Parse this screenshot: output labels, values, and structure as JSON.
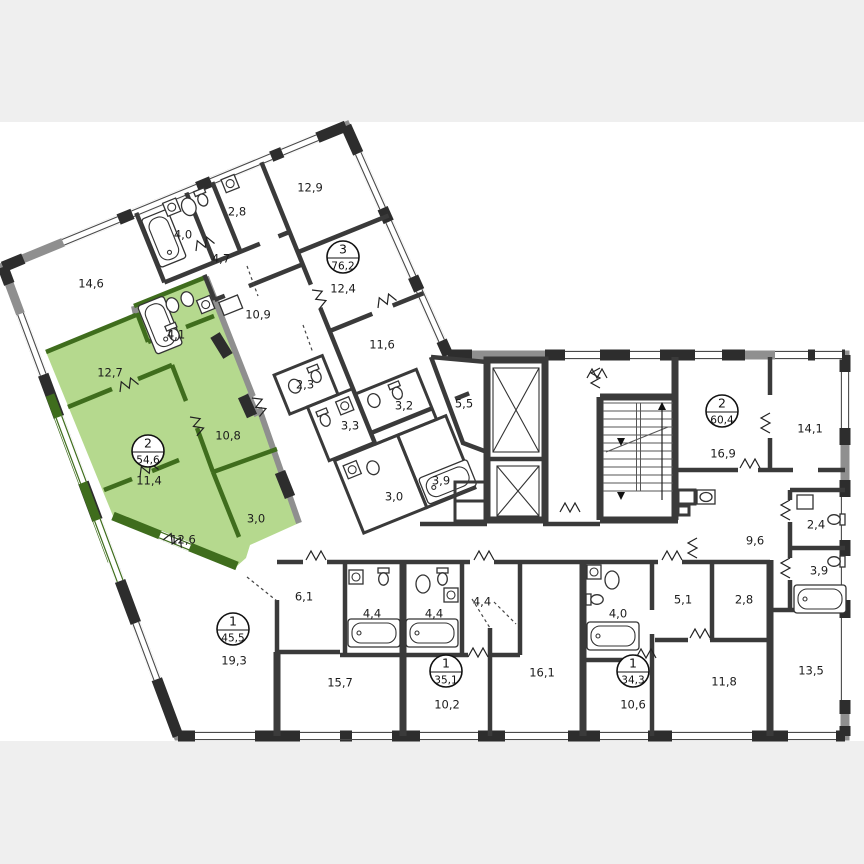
{
  "title": "Residential floor plan",
  "plan": {
    "colors": {
      "page_background": "#efefef",
      "paper": "#ffffff",
      "wall": "#3a3a3a",
      "facade": "#8f8f8f",
      "pier": "#2d2d2d",
      "highlight_fill": "#b5d98e",
      "highlight_wall": "#3f6d1d",
      "label": "#1c1c1c"
    },
    "highlighted_apartment": {
      "rooms": "2",
      "area": "54,6"
    },
    "room_labels": [
      {
        "text": "12,9",
        "x": 310,
        "y": 188
      },
      {
        "text": "2,8",
        "x": 237,
        "y": 212
      },
      {
        "text": "4,0",
        "x": 183,
        "y": 235
      },
      {
        "text": "4,7",
        "x": 221,
        "y": 259
      },
      {
        "text": "14,6",
        "x": 91,
        "y": 284
      },
      {
        "text": "12,4",
        "x": 343,
        "y": 289
      },
      {
        "text": "10,9",
        "x": 258,
        "y": 315
      },
      {
        "text": "11,6",
        "x": 382,
        "y": 345
      },
      {
        "text": "4,1",
        "x": 176,
        "y": 335
      },
      {
        "text": "12,7",
        "x": 110,
        "y": 373
      },
      {
        "text": "2,3",
        "x": 305,
        "y": 385
      },
      {
        "text": "3,2",
        "x": 404,
        "y": 406
      },
      {
        "text": "5,5",
        "x": 464,
        "y": 404
      },
      {
        "text": "3,3",
        "x": 350,
        "y": 426
      },
      {
        "text": "10,8",
        "x": 228,
        "y": 436
      },
      {
        "text": "11,4",
        "x": 149,
        "y": 481
      },
      {
        "text": "16,9",
        "x": 723,
        "y": 454
      },
      {
        "text": "14,1",
        "x": 810,
        "y": 429
      },
      {
        "text": "3,9",
        "x": 441,
        "y": 481
      },
      {
        "text": "3,0",
        "x": 394,
        "y": 497
      },
      {
        "text": "3,0",
        "x": 256,
        "y": 519
      },
      {
        "text": "12,6",
        "x": 183,
        "y": 540
      },
      {
        "text": "2,4",
        "x": 816,
        "y": 525
      },
      {
        "text": "9,6",
        "x": 755,
        "y": 541
      },
      {
        "text": "6,1",
        "x": 304,
        "y": 597
      },
      {
        "text": "3,9",
        "x": 819,
        "y": 571
      },
      {
        "text": "4,4",
        "x": 372,
        "y": 614
      },
      {
        "text": "4,4",
        "x": 434,
        "y": 614
      },
      {
        "text": "4,4",
        "x": 482,
        "y": 602
      },
      {
        "text": "4,0",
        "x": 618,
        "y": 614
      },
      {
        "text": "5,1",
        "x": 683,
        "y": 600
      },
      {
        "text": "2,8",
        "x": 744,
        "y": 600
      },
      {
        "text": "19,3",
        "x": 234,
        "y": 661
      },
      {
        "text": "15,7",
        "x": 340,
        "y": 683
      },
      {
        "text": "10,2",
        "x": 447,
        "y": 705
      },
      {
        "text": "16,1",
        "x": 542,
        "y": 673
      },
      {
        "text": "10,6",
        "x": 633,
        "y": 705
      },
      {
        "text": "11,8",
        "x": 724,
        "y": 682
      },
      {
        "text": "13,5",
        "x": 811,
        "y": 671
      }
    ],
    "apartment_badges": [
      {
        "rooms": "3",
        "area": "76,2",
        "x": 343,
        "y": 257
      },
      {
        "rooms": "2",
        "area": "54,6",
        "x": 148,
        "y": 451
      },
      {
        "rooms": "2",
        "area": "60,4",
        "x": 722,
        "y": 411
      },
      {
        "rooms": "1",
        "area": "45,5",
        "x": 233,
        "y": 629
      },
      {
        "rooms": "1",
        "area": "35,1",
        "x": 446,
        "y": 671
      },
      {
        "rooms": "1",
        "area": "34,3",
        "x": 633,
        "y": 671
      }
    ]
  }
}
